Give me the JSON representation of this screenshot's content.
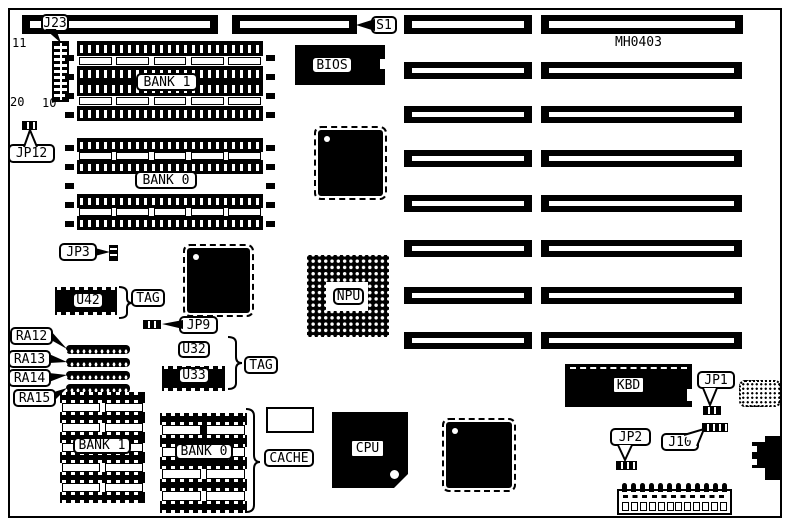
{
  "diagram": {
    "part_number": "MH0403",
    "colors": {
      "ink": "#000000",
      "paper": "#ffffff"
    },
    "labels": {
      "j23": "J23",
      "s1": "S1",
      "jp12": "JP12",
      "jp3": "JP3",
      "jp9": "JP9",
      "jp1": "JP1",
      "jp2": "JP2",
      "j10": "J10",
      "bios": "BIOS",
      "npu": "NPU",
      "cpu": "CPU",
      "kbd": "KBD",
      "simm_bank1": "BANK 1",
      "simm_bank0": "BANK 0",
      "dip_bank1": "BANK 1",
      "dip_bank0": "BANK 0",
      "cache": "CACHE",
      "tag_u42": "TAG",
      "tag_u32_u33": "TAG",
      "u42": "U42",
      "u32": "U32",
      "u33": "U33",
      "ra12": "RA12",
      "ra13": "RA13",
      "ra14": "RA14",
      "ra15": "RA15",
      "j23_pin11": "11",
      "j23_pin20": "20",
      "j23_pin10": "10"
    }
  }
}
